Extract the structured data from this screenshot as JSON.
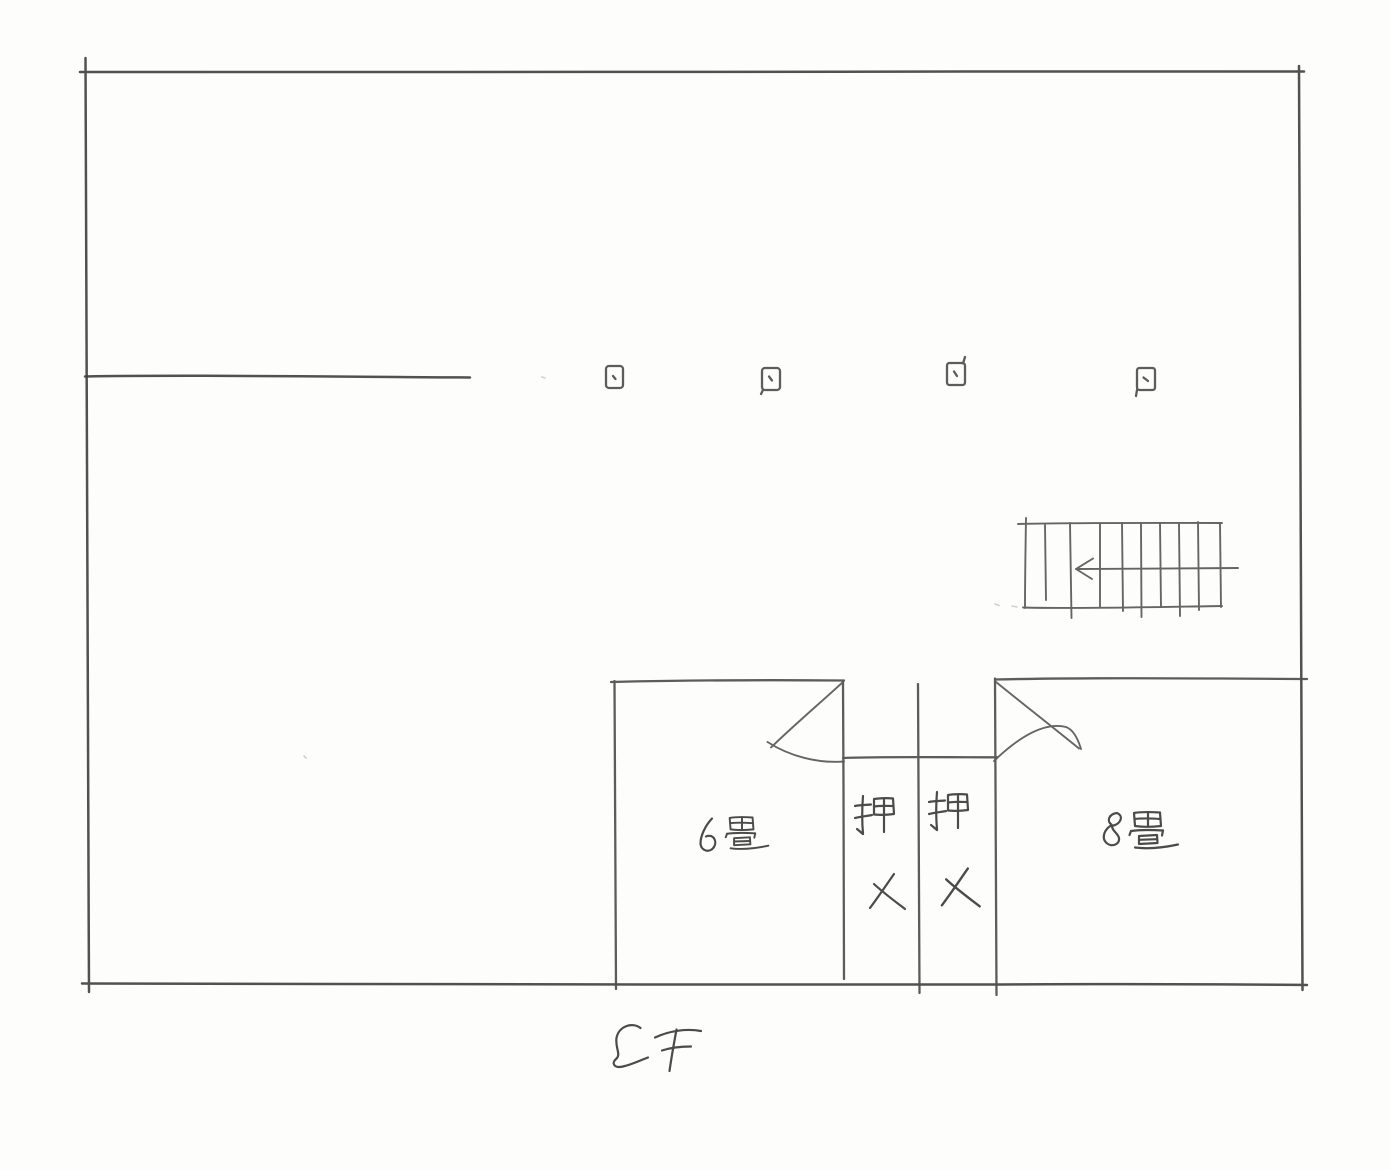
{
  "page": {
    "floor_label": "2F",
    "drawing_type": "floor-plan-sketch"
  },
  "rooms": [
    {
      "label": "6畳",
      "size_tatami": 6
    },
    {
      "label": "押入",
      "orientation": "vertical"
    },
    {
      "label": "押入",
      "orientation": "vertical"
    },
    {
      "label": "8畳",
      "size_tatami": 8
    }
  ],
  "stairs": {
    "icon": "staircase-symbol",
    "treads": 9,
    "direction_arrow": "left"
  },
  "columns": {
    "count": 4,
    "icon": "column-square-marker"
  },
  "colors": {
    "pencil": "#4f4f4f",
    "paper": "#fdfdfc"
  }
}
